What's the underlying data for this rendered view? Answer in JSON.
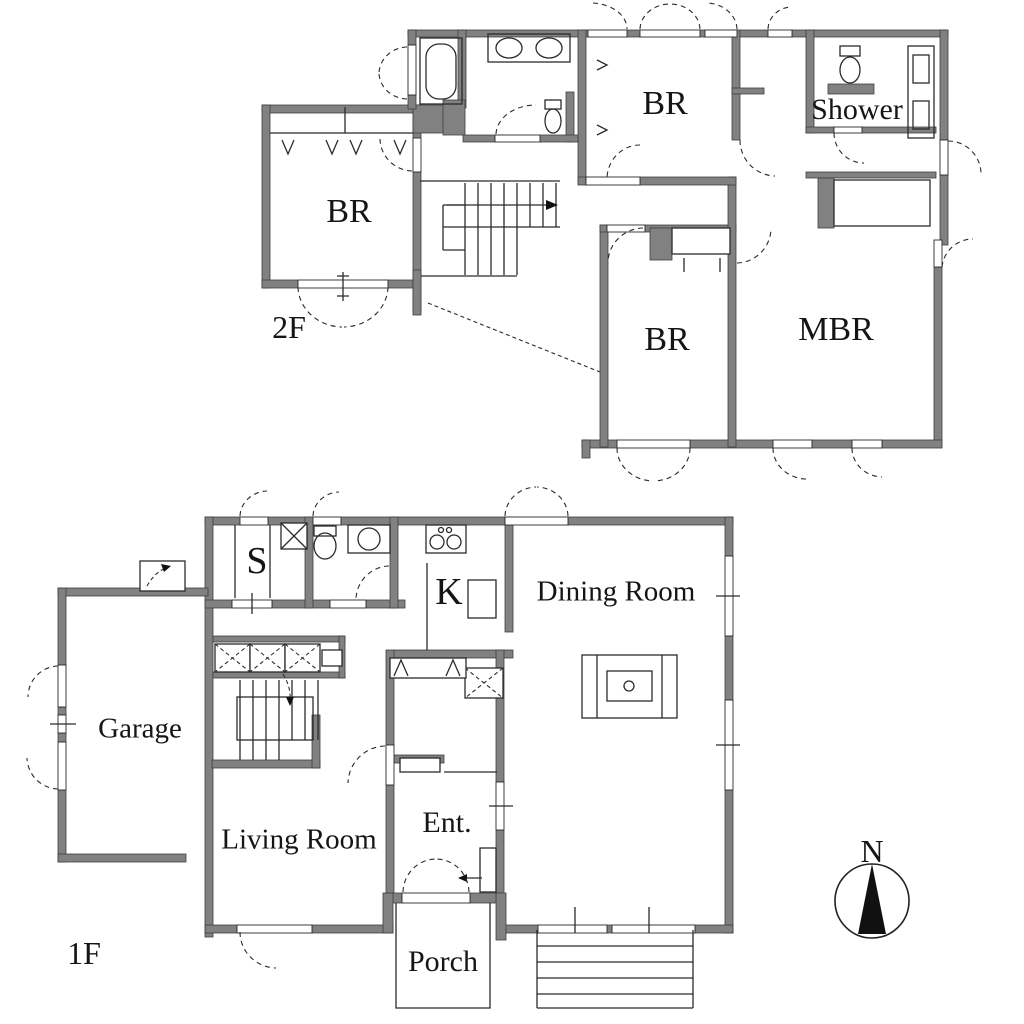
{
  "title": "Two-story house floor plan",
  "colors": {
    "background": "#ffffff",
    "wall": "#818181",
    "line": "#2b2b2b",
    "text": "#151515"
  },
  "compass": {
    "label": "N"
  },
  "floors": [
    {
      "label": "2F",
      "rooms": [
        {
          "name": "BR"
        },
        {
          "name": "BR"
        },
        {
          "name": "Shower"
        },
        {
          "name": "BR"
        },
        {
          "name": "MBR"
        }
      ]
    },
    {
      "label": "1F",
      "rooms": [
        {
          "name": "S"
        },
        {
          "name": "K"
        },
        {
          "name": "Dining Room"
        },
        {
          "name": "Garage"
        },
        {
          "name": "Living Room"
        },
        {
          "name": "Ent."
        },
        {
          "name": "Porch"
        }
      ]
    }
  ],
  "fixtures": [
    "bathtub",
    "double-sink-counter",
    "toilet",
    "shower-stall",
    "vanity-sinks",
    "staircase-2f",
    "staircase-1f",
    "closet-x-boxes",
    "kitchen-stove",
    "kitchen-sink",
    "dining-table",
    "porch-steps",
    "entry-double-door",
    "compass-north-arrow"
  ]
}
